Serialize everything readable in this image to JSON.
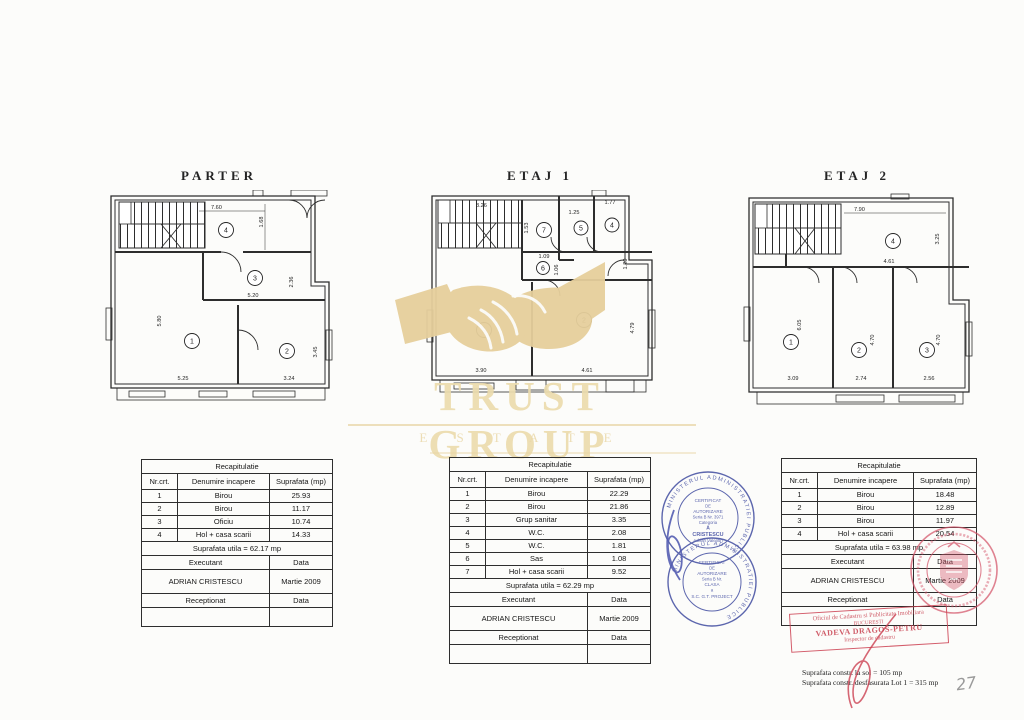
{
  "plans": [
    {
      "title": "PARTER",
      "rooms": [
        "1",
        "2",
        "3",
        "4"
      ],
      "dims": [
        "7.60",
        "1.68",
        "5.20",
        "2.36",
        "5.80",
        "5.25",
        "3.24",
        "3.45"
      ]
    },
    {
      "title": "ETAJ 1",
      "rooms": [
        "7",
        "5",
        "4",
        "6",
        "1",
        "2"
      ],
      "dims": [
        "3.26",
        "1.53",
        "1.25",
        "1.77",
        "1.09",
        "1.06",
        "1.29",
        "3.90",
        "4.61",
        "4.79"
      ]
    },
    {
      "title": "ETAJ 2",
      "rooms": [
        "4",
        "1",
        "2",
        "3"
      ],
      "dims": [
        "7.90",
        "3.25",
        "4.61",
        "6.05",
        "3.09",
        "4.70",
        "2.74",
        "4.70",
        "2.56"
      ]
    }
  ],
  "tables": [
    {
      "title": "Recapitulatie",
      "headers": [
        "Nr.crt.",
        "Denumire incapere",
        "Suprafata (mp)"
      ],
      "rows": [
        [
          "1",
          "Birou",
          "25.93"
        ],
        [
          "2",
          "Birou",
          "11.17"
        ],
        [
          "3",
          "Oficiu",
          "10.74"
        ],
        [
          "4",
          "Hol + casa scarii",
          "14.33"
        ]
      ],
      "total": "Suprafata utila = 62.17 mp",
      "executant_label": "Executant",
      "date_label": "Data",
      "executant_name": "ADRIAN CRISTESCU",
      "executant_date": "Martie 2009",
      "received_label": "Receptionat"
    },
    {
      "title": "Recapitulatie",
      "headers": [
        "Nr.crt.",
        "Denumire incapere",
        "Suprafata (mp)"
      ],
      "rows": [
        [
          "1",
          "Birou",
          "22.29"
        ],
        [
          "2",
          "Birou",
          "21.86"
        ],
        [
          "3",
          "Grup sanitar",
          "3.35"
        ],
        [
          "4",
          "W.C.",
          "2.08"
        ],
        [
          "5",
          "W.C.",
          "1.81"
        ],
        [
          "6",
          "Sas",
          "1.08"
        ],
        [
          "7",
          "Hol + casa scarii",
          "9.52"
        ]
      ],
      "total": "Suprafata utila = 62.29 mp",
      "executant_label": "Executant",
      "date_label": "Data",
      "executant_name": "ADRIAN CRISTESCU",
      "executant_date": "Martie 2009",
      "received_label": "Receptionat"
    },
    {
      "title": "Recapitulatie",
      "headers": [
        "Nr.crt.",
        "Denumire incapere",
        "Suprafata (mp)"
      ],
      "rows": [
        [
          "1",
          "Birou",
          "18.48"
        ],
        [
          "2",
          "Birou",
          "12.89"
        ],
        [
          "3",
          "Birou",
          "11.97"
        ],
        [
          "4",
          "Hol + casa scarii",
          "20.54"
        ]
      ],
      "total": "Suprafata utila = 63.98 mp",
      "executant_label": "Executant",
      "date_label": "Data",
      "executant_name": "ADRIAN CRISTESCU",
      "executant_date": "Martie 2009",
      "received_label": "Receptionat"
    }
  ],
  "watermark": {
    "brand": "TRUST GROUP",
    "subtitle": "E S T A T E"
  },
  "stamps": {
    "blue_top": {
      "ring_text": "MINISTERUL ADMINISTRATIEI PUBLICE",
      "lines": [
        "CERTIFICAT",
        "DE",
        "AUTORIZARE",
        "Seria B Nr. 3971",
        "Categoria",
        "A",
        "CRISTESCU",
        "Adrian Valentin"
      ]
    },
    "blue_bottom": {
      "ring_text": "MINISTERUL ADMINISTRATIEI PUBLICE",
      "lines": [
        "CERTIFICAT",
        "DE",
        "AUTORIZARE",
        "Seria B Nr.",
        "CLASA",
        "a",
        "S.C. G.T. PROJECT"
      ]
    },
    "red_rect": {
      "line1": "Oficiul de Cadastru si Publicitate Imobiliara",
      "line2": "BUCURESTI",
      "line3": "VADEVA DRAGOS-PETRU",
      "line4": "Inspector de cadastru"
    }
  },
  "footnotes": [
    "Suprafata constr. la sol = 105 mp",
    "Suprafata constr. desfasurata Lot 1 = 315 mp"
  ],
  "page_number": "27",
  "colors": {
    "watermark_gold": "#e6cf9c",
    "stamp_blue": "#35419b",
    "stamp_red": "#cc4152",
    "ink": "#2d2d2d"
  }
}
